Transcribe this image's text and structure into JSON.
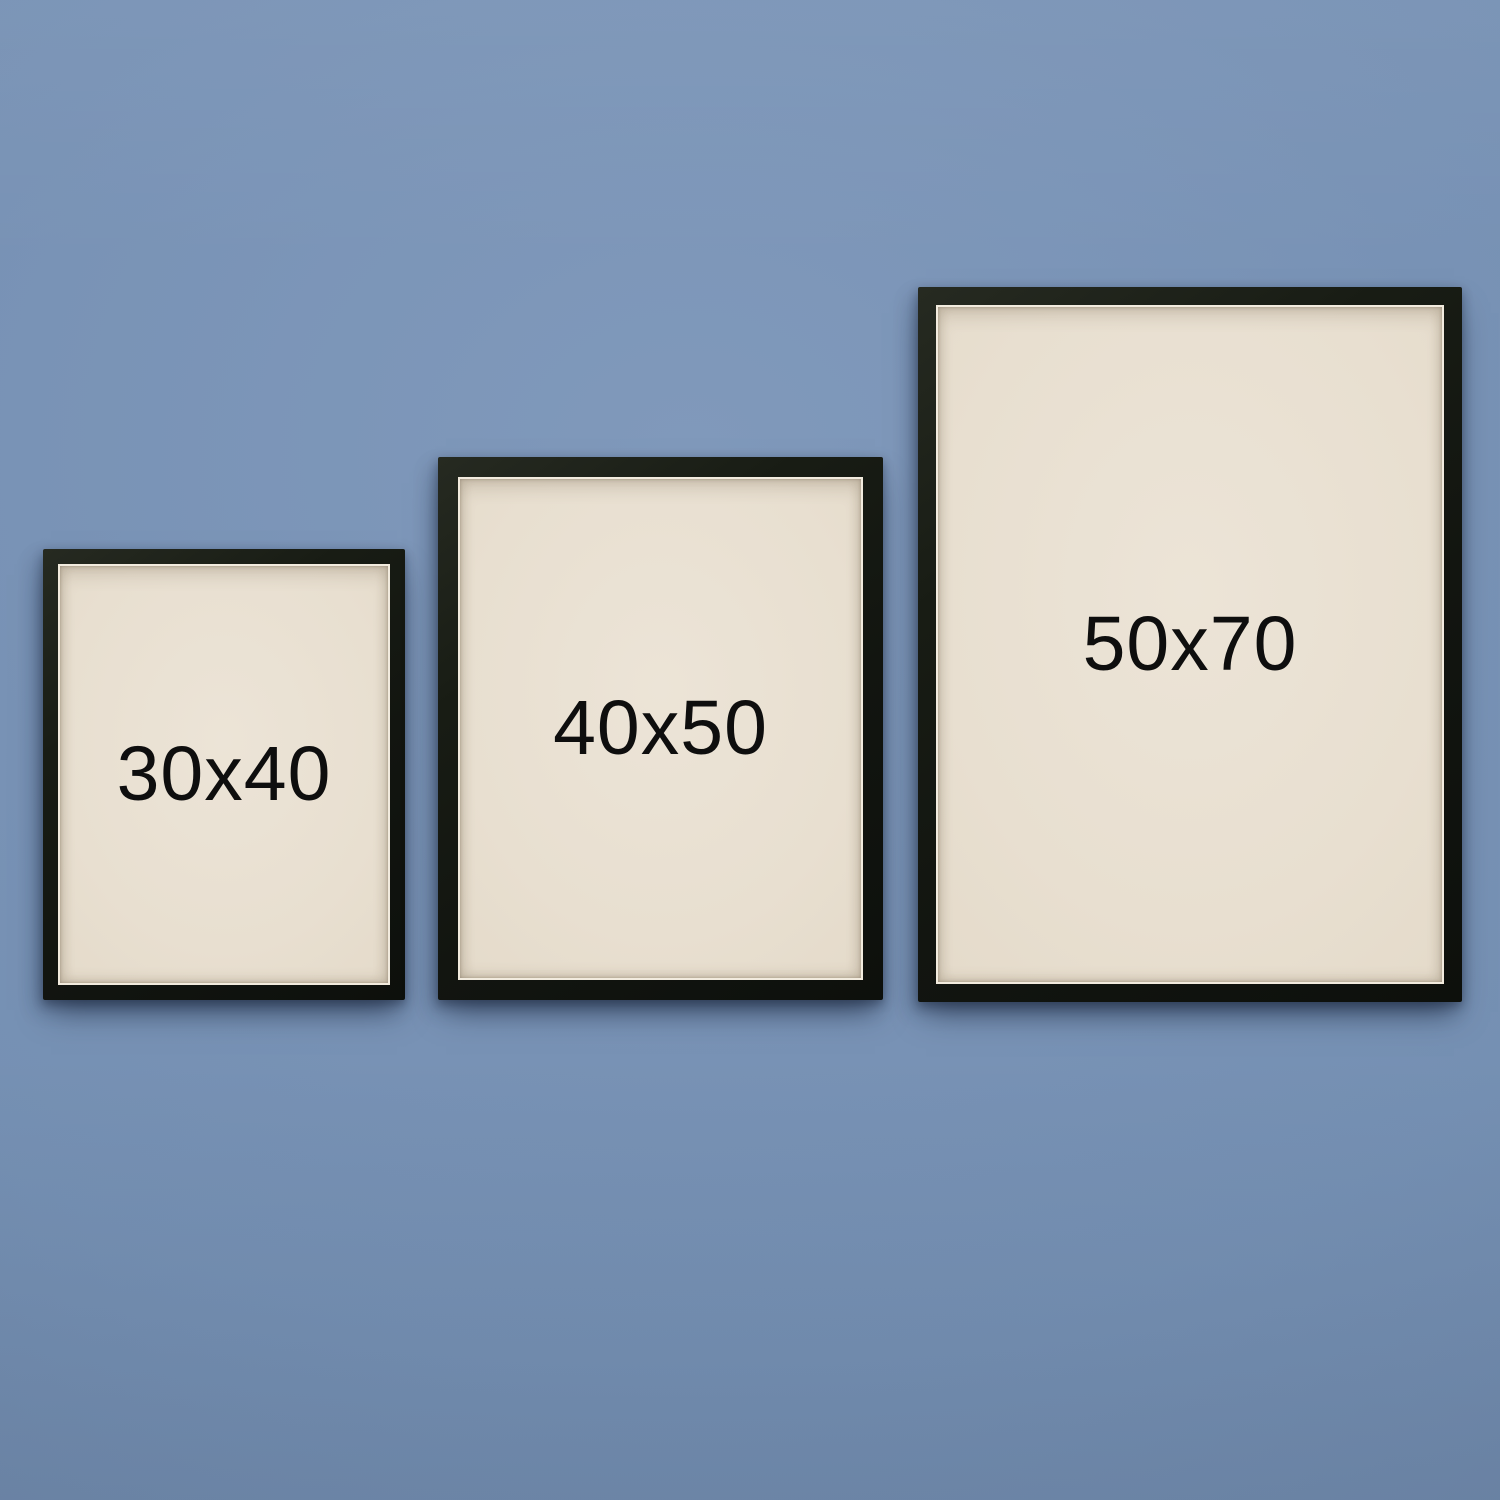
{
  "scene": {
    "description": "Three black picture frames hanging on a blue-grey wall, each showing its size",
    "colors": {
      "wall": "#7590b3",
      "frame": "#14170f",
      "paper": "#e8dfd0",
      "paper_lip": "#f2ebde",
      "label_text": "#0e0e0e"
    }
  },
  "frames": [
    {
      "label": "30x40"
    },
    {
      "label": "40x50"
    },
    {
      "label": "50x70"
    }
  ]
}
